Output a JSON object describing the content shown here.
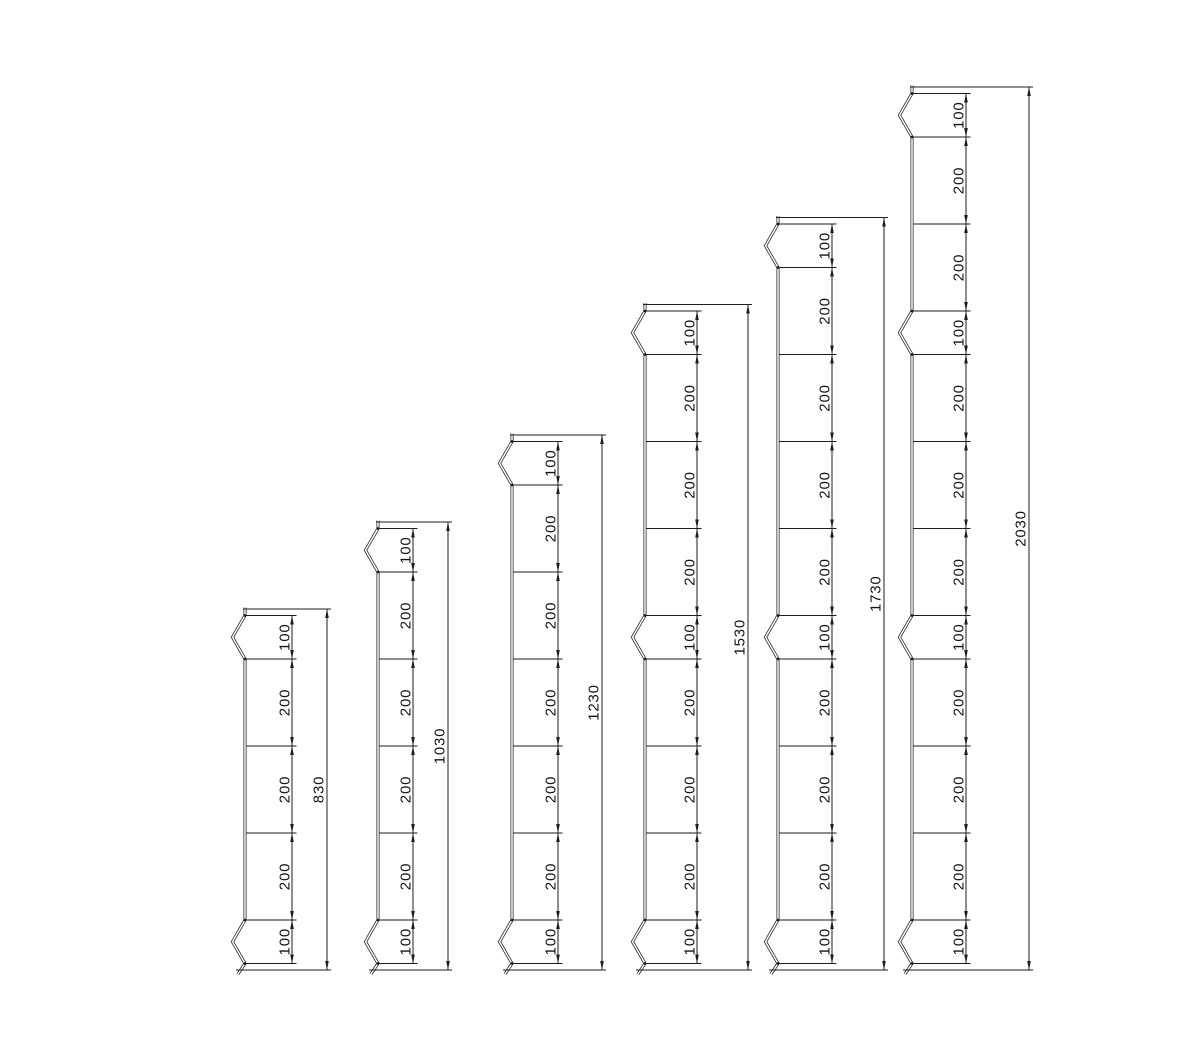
{
  "drawing": {
    "title": "post-elevation-dimension-drawing",
    "canvas": {
      "width": 1201,
      "height": 1048,
      "background": "#ffffff",
      "line_color": "#1e1e1e",
      "text_color": "#141414"
    },
    "units_to_px": 0.435,
    "baseline_y": 970,
    "end_margin_units": 15,
    "notch_depth_px": 12.5,
    "posts": [
      {
        "id": "post-830",
        "total_value": 830,
        "total_label": "830",
        "profile_x": 245,
        "chain_line_x": 292,
        "overall_line_x": 327,
        "segments": [
          {
            "value": 100,
            "label": "100",
            "notch": true
          },
          {
            "value": 200,
            "label": "200",
            "notch": false
          },
          {
            "value": 200,
            "label": "200",
            "notch": false
          },
          {
            "value": 200,
            "label": "200",
            "notch": false
          },
          {
            "value": 100,
            "label": "100",
            "notch": true
          }
        ]
      },
      {
        "id": "post-1030",
        "total_value": 1030,
        "total_label": "1030",
        "profile_x": 378,
        "chain_line_x": 413,
        "overall_line_x": 448,
        "segments": [
          {
            "value": 100,
            "label": "100",
            "notch": true
          },
          {
            "value": 200,
            "label": "200",
            "notch": false
          },
          {
            "value": 200,
            "label": "200",
            "notch": false
          },
          {
            "value": 200,
            "label": "200",
            "notch": false
          },
          {
            "value": 200,
            "label": "200",
            "notch": false
          },
          {
            "value": 100,
            "label": "100",
            "notch": true
          }
        ]
      },
      {
        "id": "post-1230",
        "total_value": 1230,
        "total_label": "1230",
        "profile_x": 512,
        "chain_line_x": 558,
        "overall_line_x": 602,
        "segments": [
          {
            "value": 100,
            "label": "100",
            "notch": true
          },
          {
            "value": 200,
            "label": "200",
            "notch": false
          },
          {
            "value": 200,
            "label": "200",
            "notch": false
          },
          {
            "value": 200,
            "label": "200",
            "notch": false
          },
          {
            "value": 200,
            "label": "200",
            "notch": false
          },
          {
            "value": 200,
            "label": "200",
            "notch": false
          },
          {
            "value": 100,
            "label": "100",
            "notch": true
          }
        ]
      },
      {
        "id": "post-1530",
        "total_value": 1530,
        "total_label": "1530",
        "profile_x": 645,
        "chain_line_x": 697,
        "overall_line_x": 748,
        "segments": [
          {
            "value": 100,
            "label": "100",
            "notch": true
          },
          {
            "value": 200,
            "label": "200",
            "notch": false
          },
          {
            "value": 200,
            "label": "200",
            "notch": false
          },
          {
            "value": 200,
            "label": "200",
            "notch": false
          },
          {
            "value": 100,
            "label": "100",
            "notch": true
          },
          {
            "value": 200,
            "label": "200",
            "notch": false
          },
          {
            "value": 200,
            "label": "200",
            "notch": false
          },
          {
            "value": 200,
            "label": "200",
            "notch": false
          },
          {
            "value": 100,
            "label": "100",
            "notch": true
          }
        ]
      },
      {
        "id": "post-1730",
        "total_value": 1730,
        "total_label": "1730",
        "profile_x": 778,
        "chain_line_x": 832,
        "overall_line_x": 884,
        "segments": [
          {
            "value": 100,
            "label": "100",
            "notch": true
          },
          {
            "value": 200,
            "label": "200",
            "notch": false
          },
          {
            "value": 200,
            "label": "200",
            "notch": false
          },
          {
            "value": 200,
            "label": "200",
            "notch": false
          },
          {
            "value": 200,
            "label": "200",
            "notch": false
          },
          {
            "value": 100,
            "label": "100",
            "notch": true
          },
          {
            "value": 200,
            "label": "200",
            "notch": false
          },
          {
            "value": 200,
            "label": "200",
            "notch": false
          },
          {
            "value": 200,
            "label": "200",
            "notch": false
          },
          {
            "value": 100,
            "label": "100",
            "notch": true
          }
        ]
      },
      {
        "id": "post-2030",
        "total_value": 2030,
        "total_label": "2030",
        "profile_x": 912,
        "chain_line_x": 966,
        "overall_line_x": 1029,
        "segments": [
          {
            "value": 100,
            "label": "100",
            "notch": true
          },
          {
            "value": 200,
            "label": "200",
            "notch": false
          },
          {
            "value": 200,
            "label": "200",
            "notch": false
          },
          {
            "value": 100,
            "label": "100",
            "notch": true
          },
          {
            "value": 200,
            "label": "200",
            "notch": false
          },
          {
            "value": 200,
            "label": "200",
            "notch": false
          },
          {
            "value": 200,
            "label": "200",
            "notch": false
          },
          {
            "value": 100,
            "label": "100",
            "notch": true
          },
          {
            "value": 200,
            "label": "200",
            "notch": false
          },
          {
            "value": 200,
            "label": "200",
            "notch": false
          },
          {
            "value": 200,
            "label": "200",
            "notch": false
          },
          {
            "value": 100,
            "label": "100",
            "notch": true
          }
        ]
      }
    ]
  }
}
